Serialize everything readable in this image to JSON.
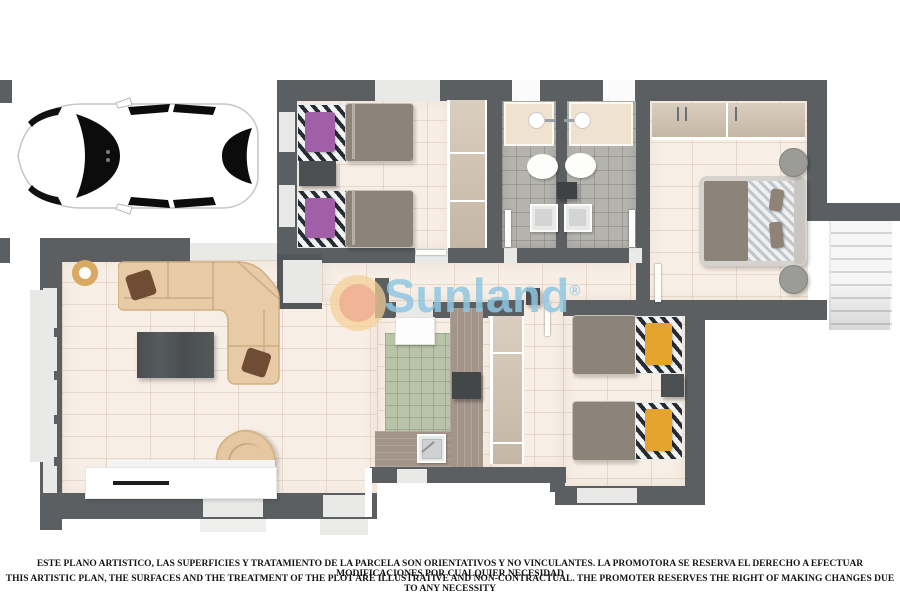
{
  "watermark": {
    "logo_text": "Sunland",
    "registered_symbol": "®",
    "logo_color": "#9fcde6",
    "sun_outer_color": "#f4d094",
    "sun_inner_color": "#eeab91"
  },
  "disclaimer": {
    "line_es": "ESTE PLANO ARTISTICO, LAS SUPERFICIES Y TRATAMIENTO DE LA PARCELA SON ORIENTATIVOS Y NO VINCULANTES. LA PROMOTORA SE RESERVA EL DERECHO A EFECTUAR MODIFICACIONES POR CUALQUIER NECESIDAD",
    "line_en": "THIS ARTISTIC PLAN, THE SURFACES AND THE TREATMENT OF THE PLOT ARE ILLUSTRATIVE AND NON-CONTRACTUAL. THE PROMOTER RESERVES THE RIGHT OF MAKING CHANGES DUE TO ANY NECESSITY"
  },
  "colors": {
    "wall": "#5b5f62",
    "floor_cream": "#f7eee5",
    "floor_bathroom": "#b4b3ae",
    "floor_kitchen_green": "#b9c3a7",
    "wardrobe_tan": "#cfc0ad",
    "sofa_beige": "#e7cba5",
    "bed_taupe": "#8c8379",
    "pillow_purple": "#a05fa6",
    "pillow_orange": "#e4a42e",
    "dark_furniture": "#4b4f52"
  }
}
